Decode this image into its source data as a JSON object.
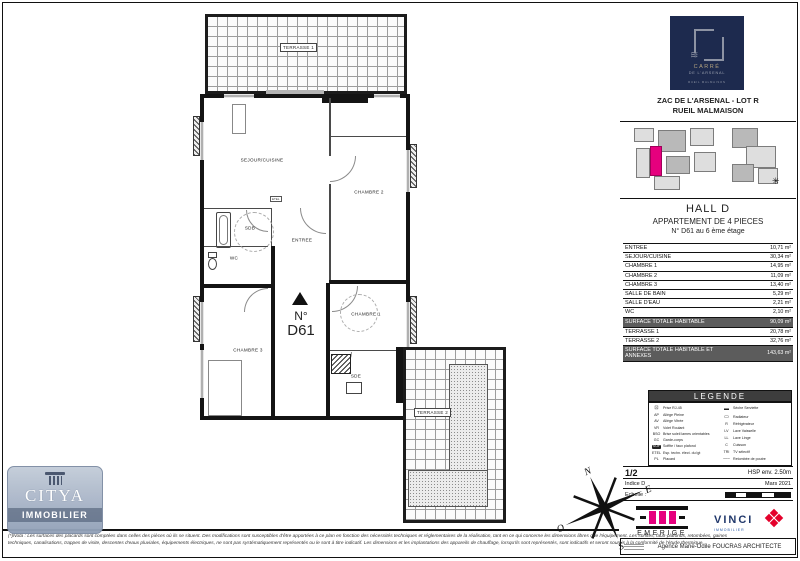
{
  "plan": {
    "terrace1_label": "TERRASSE 1",
    "terrace2_label": "TERRASSE 2",
    "rooms": {
      "sejour": "SEJOUR/CUISINE",
      "chambre1": "CHAMBRE 1",
      "chambre2": "CHAMBRE 2",
      "chambre3": "CHAMBRE 3",
      "entree": "ENTREE",
      "sdb": "SDB",
      "sde": "SDE",
      "wc": "WC",
      "etel": "ETEL"
    },
    "unit_prefix": "N°",
    "unit_number": "D61",
    "compass": {
      "n": "N",
      "e": "E",
      "s": "S",
      "o": "O"
    }
  },
  "sidebar": {
    "arsenal_logo": {
      "line1": "CARRÉ",
      "line2": "DE L'ARSENAL",
      "line3": "RUEIL MALMAISON",
      "bg": "#1d2a4e"
    },
    "project_line1": "ZAC DE L'ARSENAL - LOT R",
    "project_line2": "RUEIL MALMAISON",
    "hall": "HALL D",
    "apartment_type": "APPARTEMENT DE 4 PIECES",
    "apartment_number": "N° D61 au 6 ème étage",
    "surfaces": {
      "rows": [
        {
          "label": "ENTREE",
          "value": "10,71 m²"
        },
        {
          "label": "SEJOUR/CUISINE",
          "value": "30,34 m²"
        },
        {
          "label": "CHAMBRE 1",
          "value": "14,95 m²"
        },
        {
          "label": "CHAMBRE 2",
          "value": "11,09 m²"
        },
        {
          "label": "CHAMBRE 3",
          "value": "13,40 m²"
        },
        {
          "label": "SALLE DE BAIN",
          "value": "5,29 m²"
        },
        {
          "label": "SALLE D'EAU",
          "value": "2,21 m²"
        },
        {
          "label": "WC",
          "value": "2,10 m²"
        },
        {
          "label": "SURFACE TOTALE HABITABLE",
          "value": "90,09 m²"
        },
        {
          "label": "TERRASSE 1",
          "value": "20,78 m²"
        },
        {
          "label": "TERRASSE 2",
          "value": "32,76 m²"
        },
        {
          "label": "SURFACE TOTALE HABITABLE ET ANNEXES",
          "value": "143,63 m²"
        }
      ]
    },
    "legend": {
      "title": "LEGENDE",
      "left": [
        {
          "sym": "⊡",
          "label": "Prise RJ-45"
        },
        {
          "sym": "AP",
          "label": "Allège Pleine"
        },
        {
          "sym": "AV",
          "label": "Allège Vitrée"
        },
        {
          "sym": "VR",
          "label": "Volet Roulant"
        },
        {
          "sym": "BSO",
          "label": "Brise soleil lames orientables"
        },
        {
          "sym": "GC",
          "label": "Garde-corps"
        },
        {
          "sym": "SOF",
          "label": "Soffite / faux plafond"
        },
        {
          "sym": "ETEL",
          "label": "Esp. techn. élect. du lgt"
        },
        {
          "sym": "PL",
          "label": "Placard"
        }
      ],
      "right": [
        {
          "sym": "▬",
          "label": "Sèche Serviette"
        },
        {
          "sym": "▭",
          "label": "Radiateur"
        },
        {
          "sym": "R",
          "label": "Réfrigérateur"
        },
        {
          "sym": "LV",
          "label": "Lave Vaisselle"
        },
        {
          "sym": "LL",
          "label": "Lave Linge"
        },
        {
          "sym": "C",
          "label": "Cuisson"
        },
        {
          "sym": "TRI",
          "label": "TV sélectif"
        },
        {
          "sym": "╌╌╌",
          "label": "Retombée de poutre"
        }
      ]
    },
    "page_number": "1/2",
    "hsp": "HSP env. 2.50m",
    "indice": "Indice D",
    "date": "Mars 2021",
    "scale_label": "Echelle :",
    "emerige": "EMERIGE",
    "vinci": "VINCI",
    "vinci_sub": "IMMOBILIER",
    "architect": "Agence Marie-Odile FOUCRAS ARCHITECTE"
  },
  "footer": {
    "citya_line1": "CITYA",
    "citya_line2": "IMMOBILIER",
    "disclaimer": "(*)Nota : Les surfaces des placards sont comptées dans celles des pièces où ils se situent. Des modifications sont susceptibles d'être apportées à ce plan en fonction des nécessités techniques et réglementaires de la réalisation, tant en ce qui concerne les dimensions libres que l'équipement. Les soffites, faux-plafonds, retombées, gaines techniques, canalisations, trappes de visite, descentes d'eaux pluviales, équipements électriques, ne sont pas systématiquement représentés ou le sont à titre indicatif. Les dimensions et les implantations des appareils de chauffage, lorsqu'ils sont représentés, sont indicatifs et seront soumis à la conformité de l'étude thermique."
  }
}
